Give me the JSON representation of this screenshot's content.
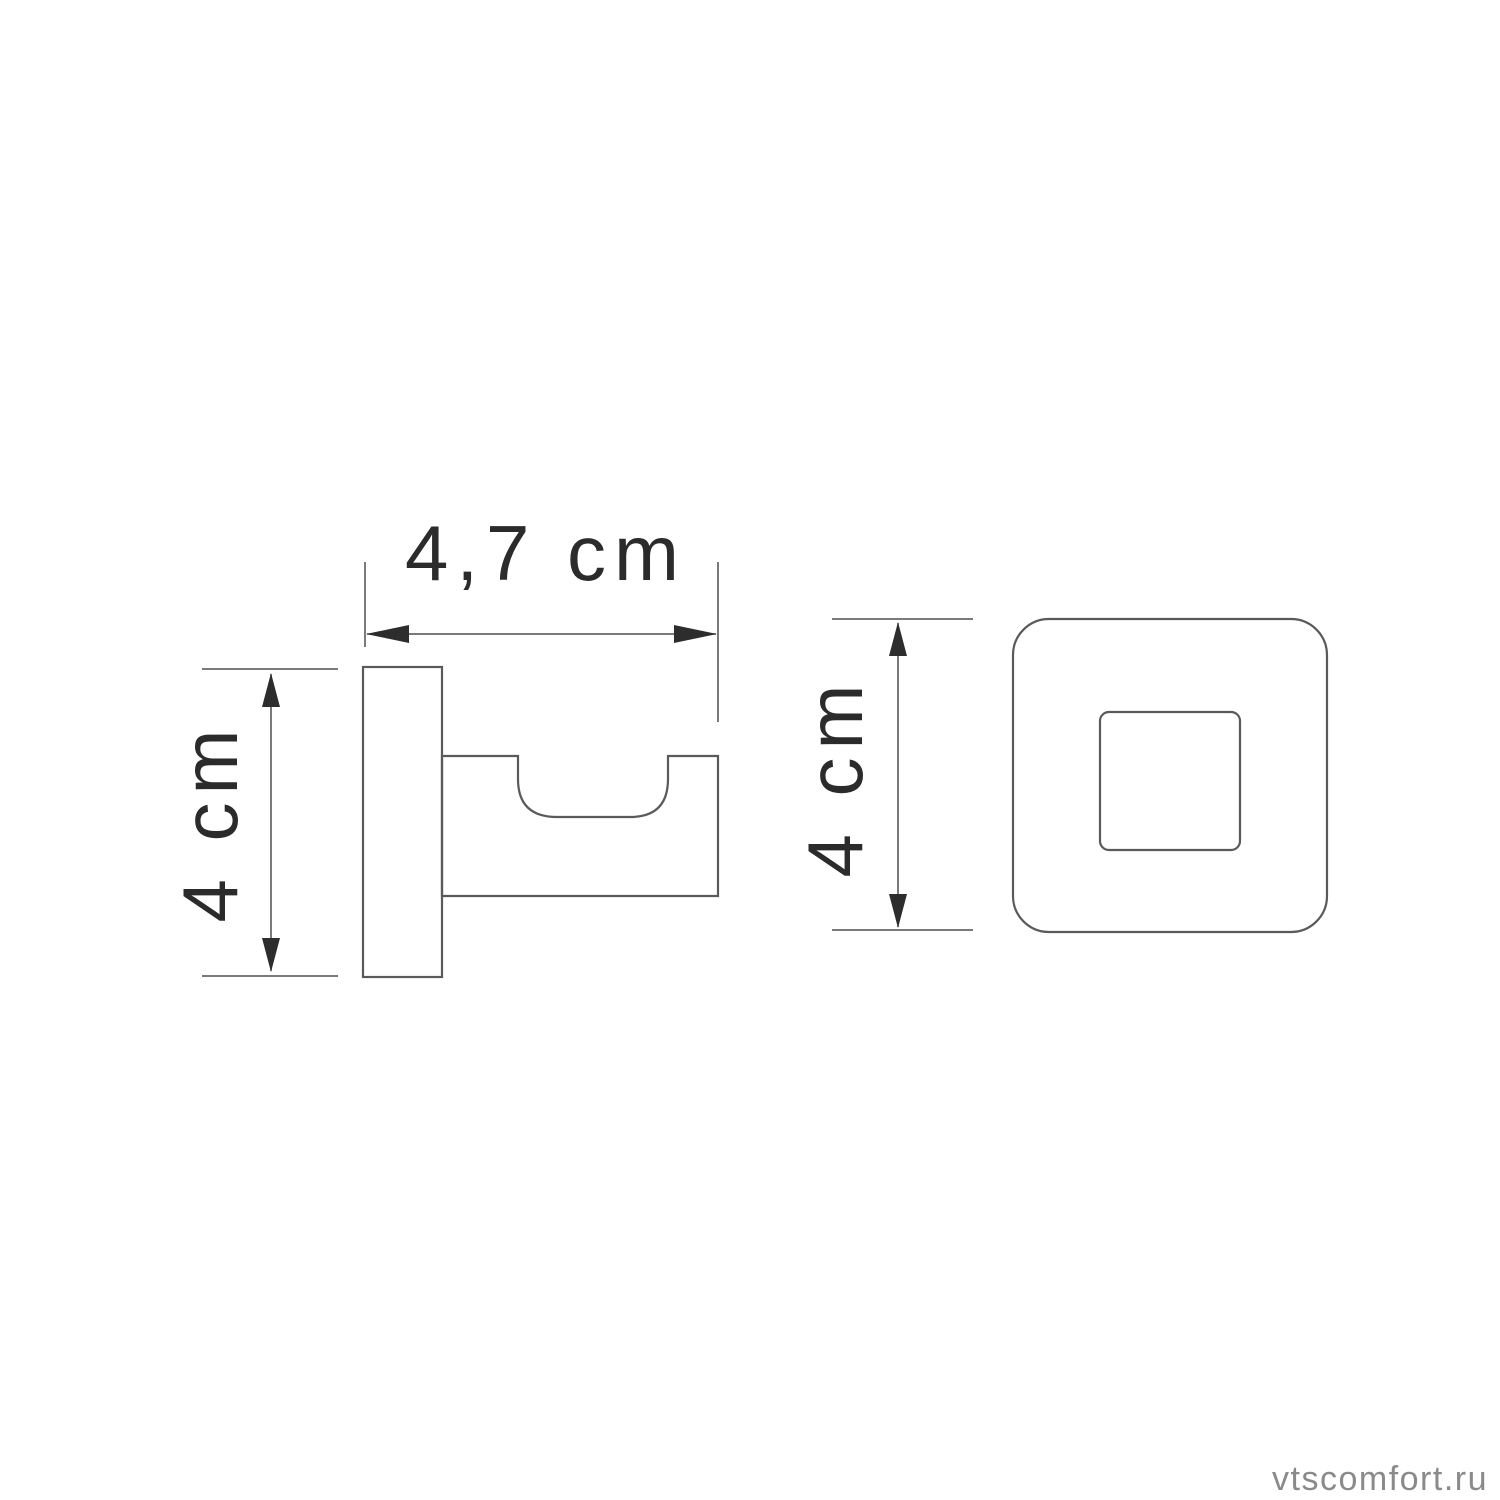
{
  "page": {
    "background_color": "#ffffff"
  },
  "dimensions": {
    "depth_label": "4,7 cm",
    "side_height_label": "4 cm",
    "front_height_label": "4 cm"
  },
  "watermark": {
    "text": "vtscomfort.ru",
    "color": "#8a8a8a"
  },
  "colors": {
    "outline": "#5a5a5a",
    "dimension_line": "#4f4f4f",
    "dimension_text": "#2b2b2b"
  }
}
